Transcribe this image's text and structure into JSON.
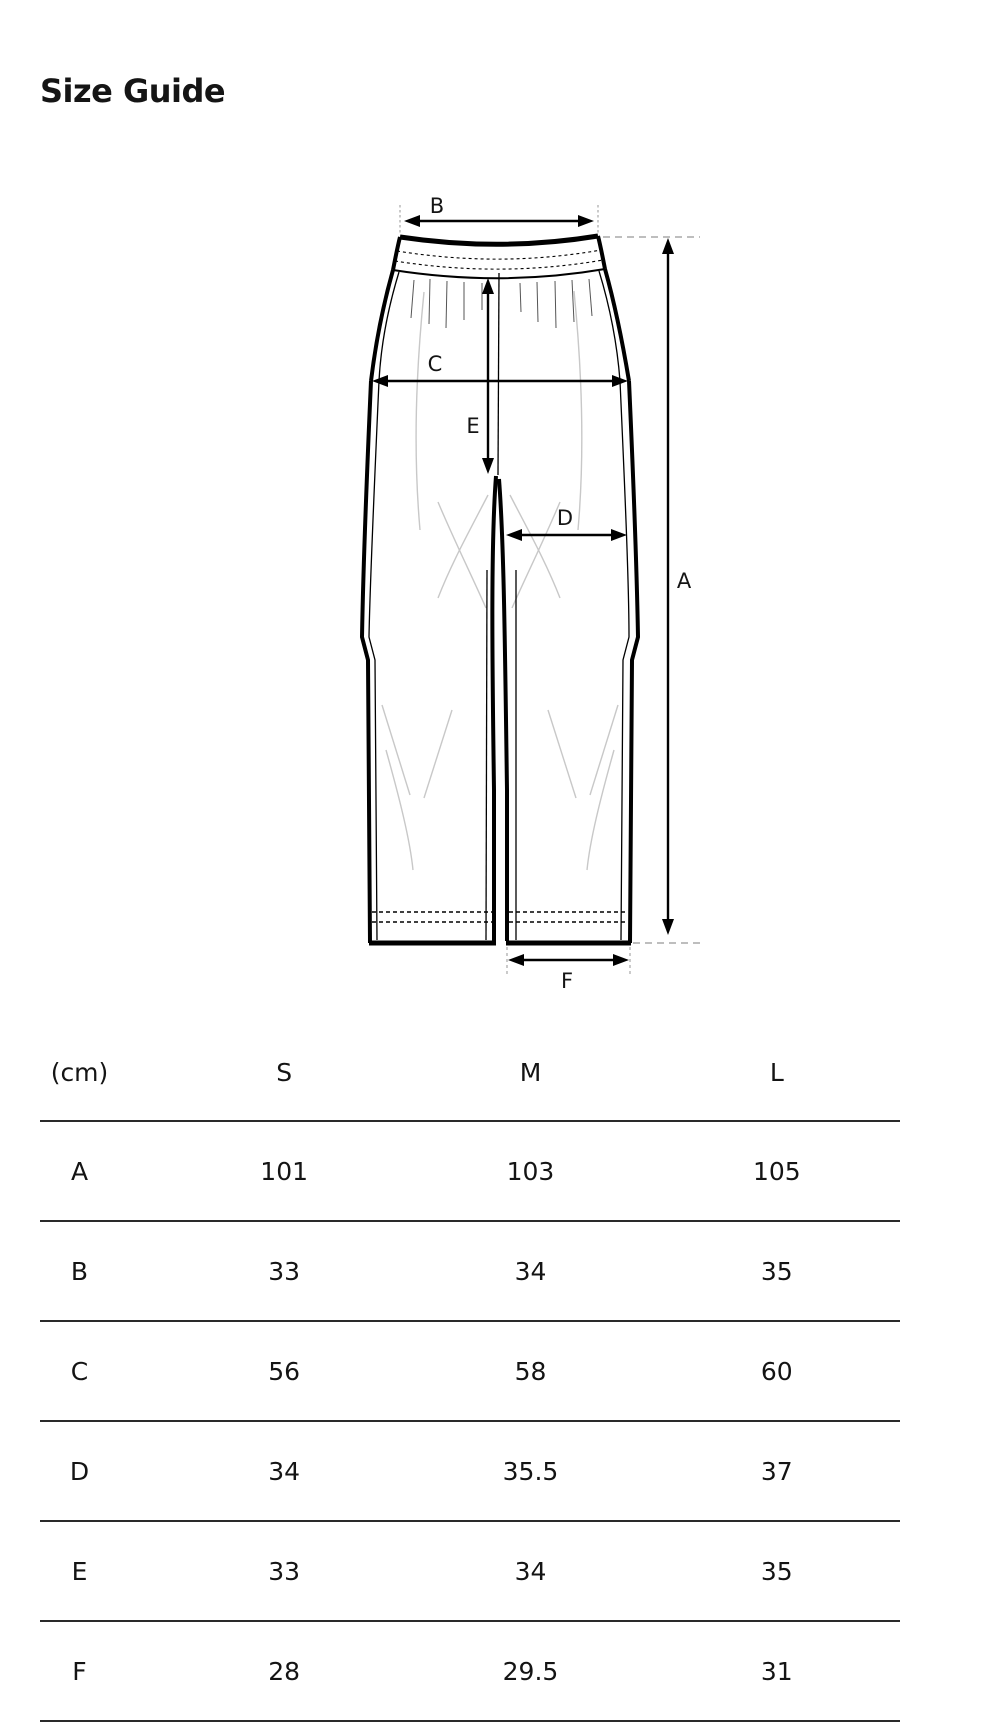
{
  "page": {
    "title": "Size Guide"
  },
  "colors": {
    "ink": "#111111",
    "outline": "#000000",
    "guide_dash": "#a8a8a8",
    "crease": "#c8c8c8",
    "table_rule": "#2a2a2a"
  },
  "diagram": {
    "type": "pants-flat-sketch",
    "labels": {
      "a": "A",
      "b": "B",
      "c": "C",
      "d": "D",
      "e": "E",
      "f": "F"
    }
  },
  "table": {
    "unit_header": "(cm)",
    "columns": [
      "S",
      "M",
      "L"
    ],
    "rows": [
      {
        "label": "A",
        "values": [
          "101",
          "103",
          "105"
        ]
      },
      {
        "label": "B",
        "values": [
          "33",
          "34",
          "35"
        ]
      },
      {
        "label": "C",
        "values": [
          "56",
          "58",
          "60"
        ]
      },
      {
        "label": "D",
        "values": [
          "34",
          "35.5",
          "37"
        ]
      },
      {
        "label": "E",
        "values": [
          "33",
          "34",
          "35"
        ]
      },
      {
        "label": "F",
        "values": [
          "28",
          "29.5",
          "31"
        ]
      }
    ]
  }
}
